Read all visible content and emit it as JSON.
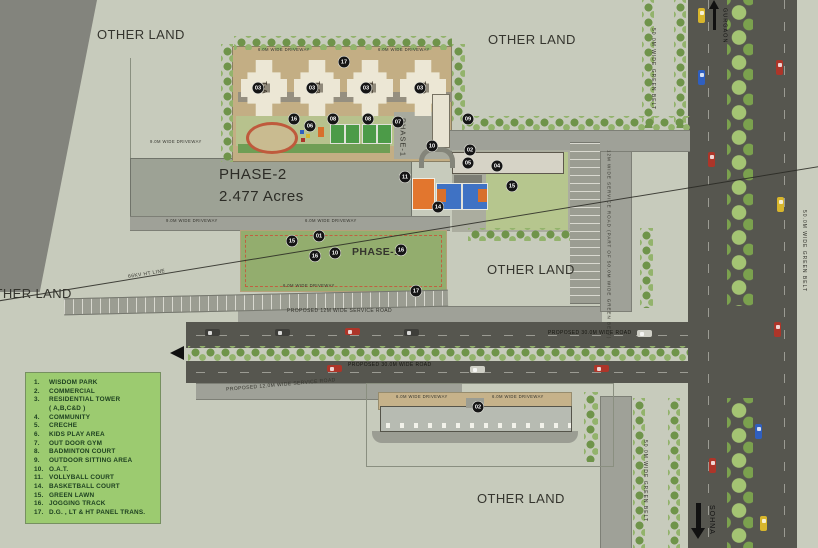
{
  "colors": {
    "background": "#c7cbbc",
    "road_dark": "#56564f",
    "road_light": "#9fa198",
    "legend_bg": "#9ccb70",
    "legend_text": "#1d4020",
    "lawn_green": "#93ad6e",
    "driveway_tan": "#c3ae84",
    "court_blue": "#3f72c4",
    "court_orange": "#e2762e",
    "court_green": "#4c9b48",
    "tree_green": "#7ba14e",
    "marker": "#151515",
    "tower_cream": "#ece7d5",
    "phase2_gray": "#9da295"
  },
  "phase2": {
    "title": "PHASE-2",
    "area": "2.477 Acres"
  },
  "towers": [
    {
      "label": "T-A"
    },
    {
      "label": "T-B"
    },
    {
      "label": "T-C"
    },
    {
      "label": "T-D"
    }
  ],
  "legend": {
    "items": [
      {
        "num": "1.",
        "label": "WISDOM PARK"
      },
      {
        "num": "2.",
        "label": "COMMERCIAL"
      },
      {
        "num": "3.",
        "label": "RESIDENTIAL TOWER"
      },
      {
        "num": "",
        "label": "( A,B,C&D )"
      },
      {
        "num": "4.",
        "label": "COMMUNITY"
      },
      {
        "num": "5.",
        "label": "CRECHE"
      },
      {
        "num": "6.",
        "label": "KIDS PLAY AREA"
      },
      {
        "num": "7.",
        "label": "OUT DOOR GYM"
      },
      {
        "num": "8.",
        "label": "BADMINTON COURT"
      },
      {
        "num": "9.",
        "label": "OUTDOOR SITTING AREA"
      },
      {
        "num": "10.",
        "label": "O.A.T."
      },
      {
        "num": "11.",
        "label": "VOLLYBALL COURT"
      },
      {
        "num": "14.",
        "label": "BASKETBALL COURT"
      },
      {
        "num": "15.",
        "label": "GREEN LAWN"
      },
      {
        "num": "16.",
        "label": "JOGGING TRACK"
      },
      {
        "num": "17.",
        "label": "D.G. , LT & HT PANEL TRANS."
      }
    ]
  },
  "labels": [
    {
      "name": "other-land-top-left",
      "text": "OTHER LAND",
      "x": 97,
      "y": 28,
      "size": 13
    },
    {
      "name": "other-land-top-right",
      "text": "OTHER LAND",
      "x": 488,
      "y": 33,
      "size": 13
    },
    {
      "name": "other-land-mid-right",
      "text": "OTHER LAND",
      "x": 487,
      "y": 263,
      "size": 13
    },
    {
      "name": "other-land-bottom",
      "text": "OTHER LAND",
      "x": 477,
      "y": 492,
      "size": 13
    },
    {
      "name": "other-land-left",
      "text": "OTHER LAND",
      "x": -16,
      "y": 287,
      "size": 13
    },
    {
      "name": "phase1-compound",
      "text": "PHASE-1",
      "x": 399,
      "y": 118,
      "size": 7.5,
      "vert": true
    },
    {
      "name": "phase1-lawn",
      "text": "PHASE-1",
      "x": 352,
      "y": 247,
      "size": 10.5,
      "bold": true
    },
    {
      "name": "road-service-top",
      "text": "PROPOSED 12M WIDE SERVICE ROAD",
      "x": 287,
      "y": 309,
      "size": 5
    },
    {
      "name": "road-30m-upper",
      "text": "PROPOSED 30.0M WIDE ROAD",
      "x": 548,
      "y": 331,
      "size": 5,
      "color": "#15150f"
    },
    {
      "name": "road-30m-lower",
      "text": "PROPOSED 30.0M WIDE ROAD",
      "x": 348,
      "y": 363,
      "size": 5,
      "color": "#15150f"
    },
    {
      "name": "road-service-bottom",
      "text": "PROPOSED 12.0M WIDE SERVICE ROAD",
      "x": 226,
      "y": 383,
      "size": 5,
      "rot": -5
    },
    {
      "name": "road-vertical-service",
      "text": "12M WIDE SERVICE ROAD (PART OF 50.0M WIDE GREEN BELT)",
      "x": 606,
      "y": 150,
      "size": 4.5,
      "vert": true
    },
    {
      "name": "green-belt-top",
      "text": "50.0M WIDE GREEN BELT",
      "x": 650,
      "y": 28,
      "size": 5,
      "vert": true
    },
    {
      "name": "green-belt-bottom",
      "text": "50.0M WIDE GREEN BELT",
      "x": 642,
      "y": 440,
      "size": 5,
      "vert": true
    },
    {
      "name": "green-belt-right",
      "text": "50.0M WIDE GREEN BELT",
      "x": 801,
      "y": 210,
      "size": 5,
      "vert": true
    },
    {
      "name": "ht-line-label",
      "text": "66KV HT LINE",
      "x": 128,
      "y": 272,
      "size": 5,
      "rot": -9
    },
    {
      "name": "to-gurgaon",
      "text": "GURGAON",
      "x": 721,
      "y": 8,
      "size": 5.5,
      "vert": true,
      "color": "#111"
    },
    {
      "name": "to-sohna",
      "text": "SOHNA",
      "x": 708,
      "y": 505,
      "size": 7,
      "vert": true,
      "color": "#111"
    },
    {
      "name": "driveway-compound-1",
      "text": "6.0M WIDE DRIVEWAY",
      "x": 258,
      "y": 48,
      "size": 4.2
    },
    {
      "name": "driveway-compound-2",
      "text": "6.0M WIDE DRIVEWAY",
      "x": 378,
      "y": 48,
      "size": 4.2
    },
    {
      "name": "driveway-phase2-top",
      "text": "9.0M WIDE DRIVEWAY",
      "x": 150,
      "y": 140,
      "size": 4.2
    },
    {
      "name": "driveway-phase2-bottom",
      "text": "9.0M WIDE DRIVEWAY",
      "x": 166,
      "y": 219,
      "size": 4.2
    },
    {
      "name": "driveway-lawn-top",
      "text": "6.0M WIDE DRIVEWAY",
      "x": 305,
      "y": 219,
      "size": 4.2
    },
    {
      "name": "driveway-lawn-bottom",
      "text": "6.0M WIDE DRIVEWAY",
      "x": 283,
      "y": 284,
      "size": 4.2
    },
    {
      "name": "driveway-commercial-1",
      "text": "6.0M WIDE DRIVEWAY",
      "x": 396,
      "y": 395,
      "size": 4.2
    },
    {
      "name": "driveway-commercial-2",
      "text": "6.0M WIDE DRIVEWAY",
      "x": 492,
      "y": 395,
      "size": 4.2
    }
  ],
  "markers": [
    {
      "n": "17",
      "x": 344,
      "y": 62
    },
    {
      "n": "03",
      "x": 258,
      "y": 88
    },
    {
      "n": "03",
      "x": 312,
      "y": 88
    },
    {
      "n": "03",
      "x": 366,
      "y": 88
    },
    {
      "n": "03",
      "x": 420,
      "y": 88
    },
    {
      "n": "16",
      "x": 294,
      "y": 119
    },
    {
      "n": "06",
      "x": 310,
      "y": 126
    },
    {
      "n": "08",
      "x": 333,
      "y": 119
    },
    {
      "n": "08",
      "x": 368,
      "y": 119
    },
    {
      "n": "07",
      "x": 398,
      "y": 122
    },
    {
      "n": "09",
      "x": 468,
      "y": 119
    },
    {
      "n": "10",
      "x": 432,
      "y": 146
    },
    {
      "n": "02",
      "x": 470,
      "y": 150
    },
    {
      "n": "05",
      "x": 468,
      "y": 163
    },
    {
      "n": "04",
      "x": 497,
      "y": 166
    },
    {
      "n": "11",
      "x": 405,
      "y": 177
    },
    {
      "n": "14",
      "x": 438,
      "y": 207
    },
    {
      "n": "15",
      "x": 512,
      "y": 186
    },
    {
      "n": "15",
      "x": 292,
      "y": 241
    },
    {
      "n": "01",
      "x": 319,
      "y": 236
    },
    {
      "n": "16",
      "x": 315,
      "y": 256
    },
    {
      "n": "10",
      "x": 335,
      "y": 253
    },
    {
      "n": "16",
      "x": 401,
      "y": 250
    },
    {
      "n": "17",
      "x": 416,
      "y": 291
    },
    {
      "n": "02",
      "x": 478,
      "y": 407
    }
  ],
  "cars": {
    "horizontal": [
      {
        "x": 205,
        "y": 329,
        "c": "#3e3e3a"
      },
      {
        "x": 275,
        "y": 329,
        "c": "#3e3e3a"
      },
      {
        "x": 345,
        "y": 328,
        "c": "#ad3529"
      },
      {
        "x": 404,
        "y": 329,
        "c": "#3e3e3a"
      },
      {
        "x": 637,
        "y": 330,
        "c": "#cfcfc6"
      },
      {
        "x": 327,
        "y": 365,
        "c": "#ad3529"
      },
      {
        "x": 470,
        "y": 366,
        "c": "#cfcfc6"
      },
      {
        "x": 594,
        "y": 365,
        "c": "#ad3529"
      }
    ],
    "vertical": [
      {
        "x": 698,
        "y": 8,
        "c": "#d8b62c"
      },
      {
        "x": 698,
        "y": 70,
        "c": "#2f5fc0"
      },
      {
        "x": 708,
        "y": 152,
        "c": "#ad3529"
      },
      {
        "x": 776,
        "y": 60,
        "c": "#ad3529"
      },
      {
        "x": 777,
        "y": 197,
        "c": "#d8b62c"
      },
      {
        "x": 774,
        "y": 322,
        "c": "#ad3529"
      },
      {
        "x": 755,
        "y": 424,
        "c": "#2f5fc0"
      },
      {
        "x": 709,
        "y": 458,
        "c": "#ad3529"
      },
      {
        "x": 760,
        "y": 516,
        "c": "#d8b62c"
      }
    ]
  }
}
